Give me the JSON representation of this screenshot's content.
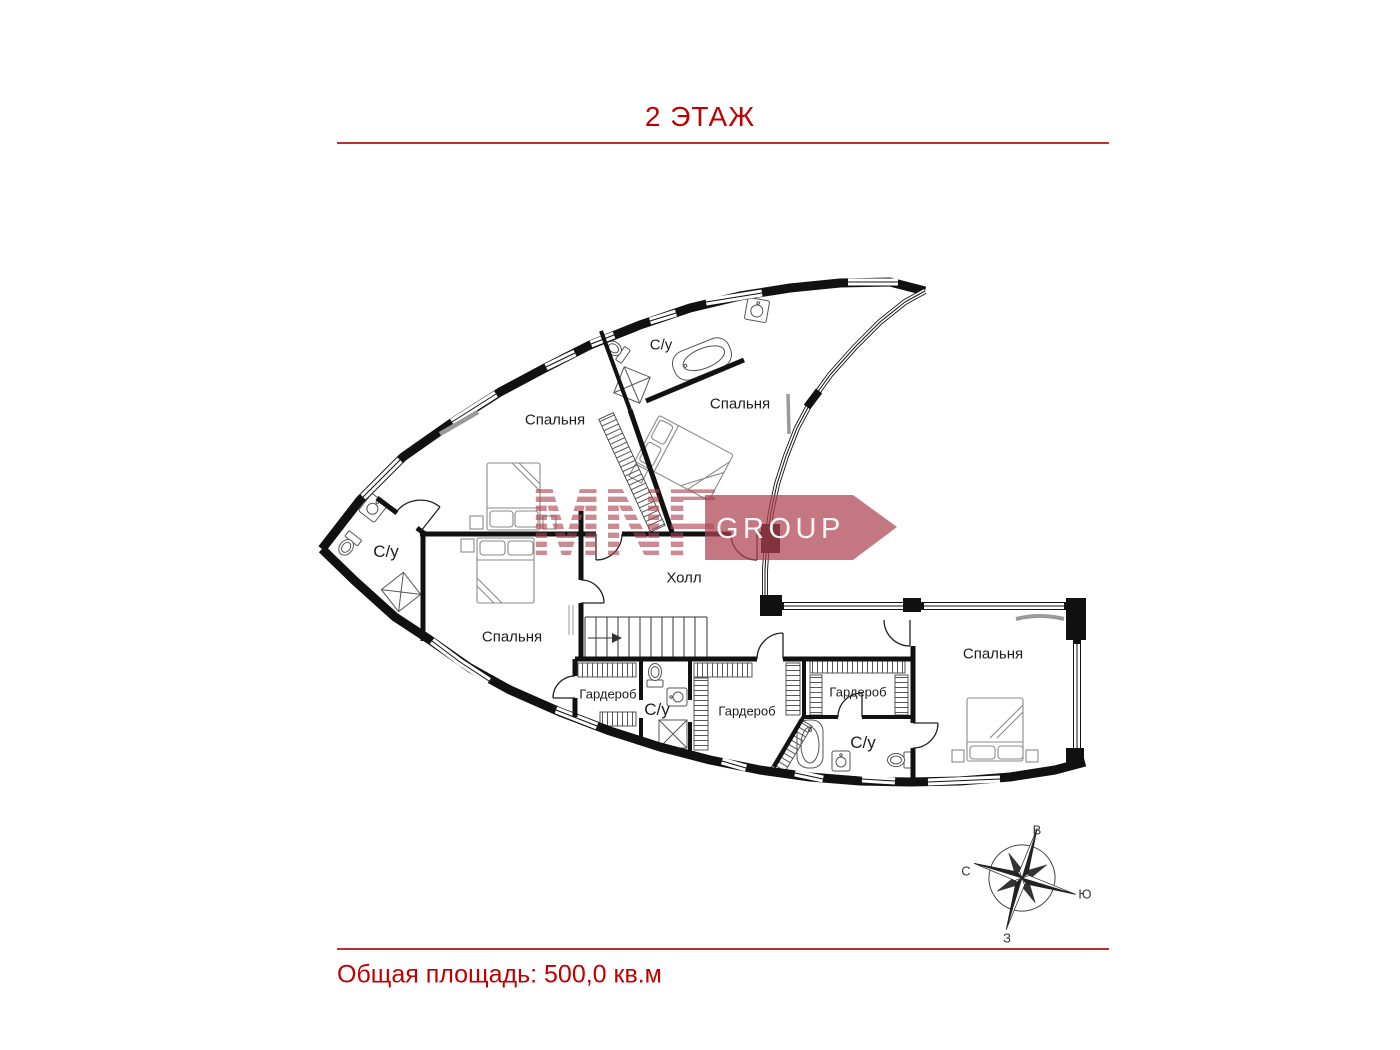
{
  "header": {
    "title": "2 ЭТАЖ"
  },
  "footer": {
    "area_label": "Общая площадь: 500,0 кв.м"
  },
  "watermark": {
    "brand": "MNF",
    "group": "GROUP",
    "color": "#ad4350"
  },
  "colors": {
    "accent": "#c00000",
    "divider": "#b83232",
    "walls": "#111111"
  },
  "rooms": [
    {
      "label": "Спальня",
      "x": 555,
      "y": 420,
      "size": "m"
    },
    {
      "label": "С/у",
      "x": 661,
      "y": 345,
      "size": "m"
    },
    {
      "label": "Спальня",
      "x": 740,
      "y": 404,
      "size": "m"
    },
    {
      "label": "С/у",
      "x": 386,
      "y": 552,
      "size": "l"
    },
    {
      "label": "Спальня",
      "x": 512,
      "y": 637,
      "size": "m"
    },
    {
      "label": "Холл",
      "x": 684,
      "y": 578,
      "size": "m"
    },
    {
      "label": "Гардероб",
      "x": 608,
      "y": 694,
      "size": "s"
    },
    {
      "label": "С/у",
      "x": 657,
      "y": 710,
      "size": "l"
    },
    {
      "label": "Гардероб",
      "x": 747,
      "y": 711,
      "size": "s"
    },
    {
      "label": "Гардероб",
      "x": 858,
      "y": 692,
      "size": "s"
    },
    {
      "label": "С/у",
      "x": 863,
      "y": 743,
      "size": "l"
    },
    {
      "label": "Спальня",
      "x": 993,
      "y": 654,
      "size": "m"
    }
  ],
  "compass": {
    "points": [
      {
        "label": "В",
        "x": 1037,
        "y": 830
      },
      {
        "label": "С",
        "x": 966,
        "y": 871
      },
      {
        "label": "Ю",
        "x": 1085,
        "y": 894
      },
      {
        "label": "З",
        "x": 1007,
        "y": 938
      }
    ]
  }
}
